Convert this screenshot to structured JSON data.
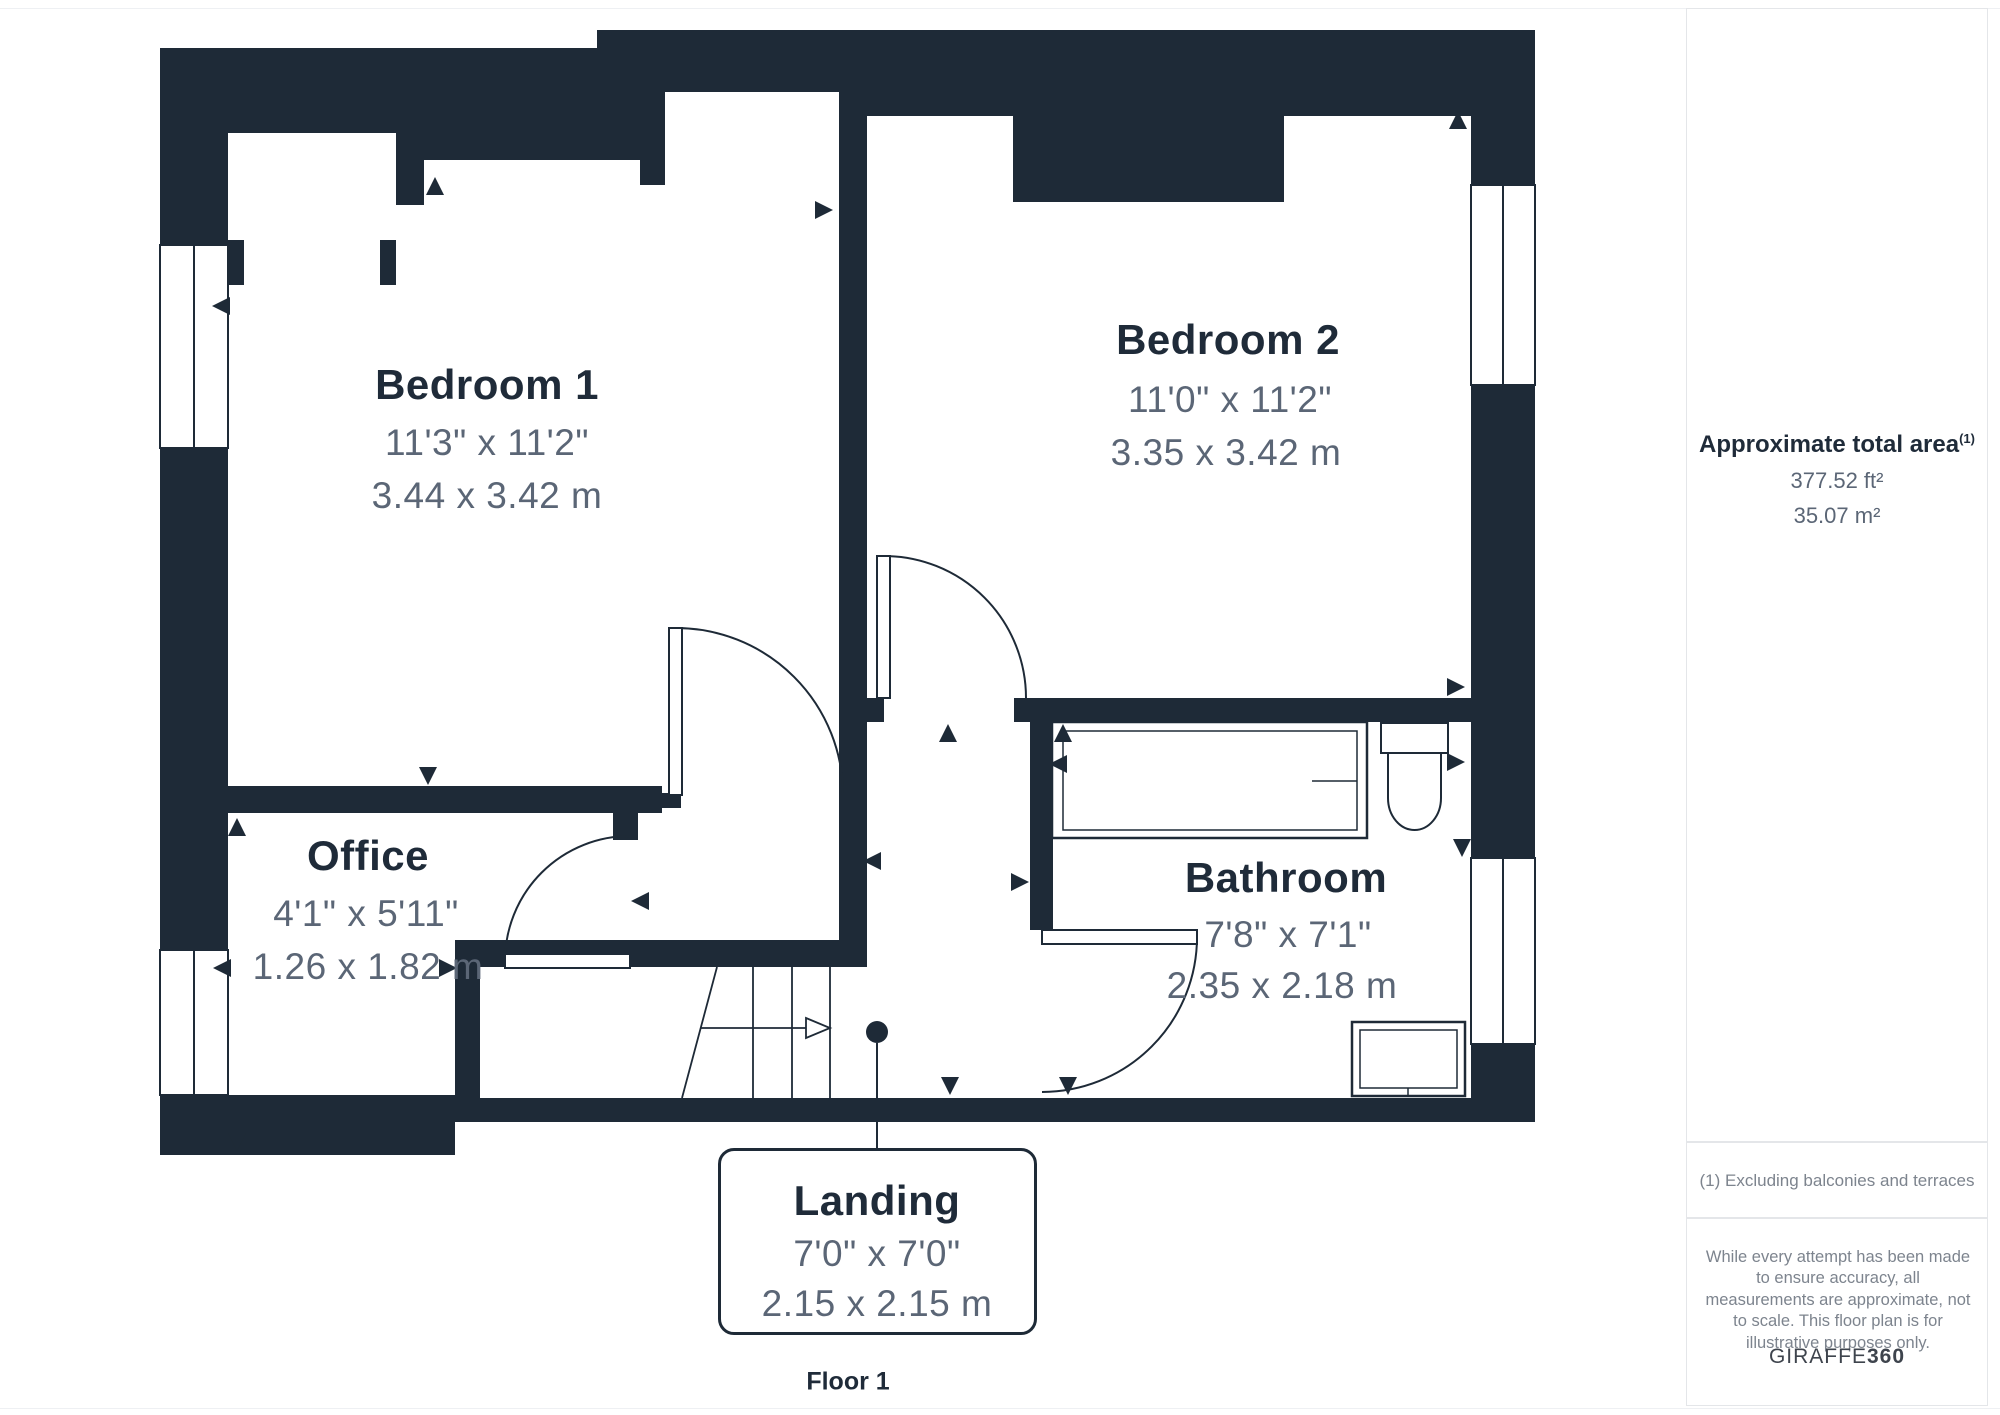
{
  "plan": {
    "floor_label": "Floor 1",
    "rooms": {
      "bedroom1": {
        "name": "Bedroom 1",
        "dims_imperial": "11'3\" x 11'2\"",
        "dims_metric": "3.44 x 3.42 m"
      },
      "bedroom2": {
        "name": "Bedroom 2",
        "dims_imperial": "11'0\" x 11'2\"",
        "dims_metric": "3.35 x 3.42 m"
      },
      "office": {
        "name": "Office",
        "dims_imperial": "4'1\" x 5'11\"",
        "dims_metric": "1.26 x 1.82 m"
      },
      "bathroom": {
        "name": "Bathroom",
        "dims_imperial": "7'8\" x 7'1\"",
        "dims_metric": "2.35 x 2.18 m"
      },
      "landing": {
        "name": "Landing",
        "dims_imperial": "7'0\" x 7'0\"",
        "dims_metric": "2.15 x 2.15 m"
      }
    }
  },
  "sidebar": {
    "area_title": "Approximate total area",
    "area_footnote_marker": "(1)",
    "area_ft": "377.52 ft²",
    "area_m": "35.07 m²",
    "footnote": "(1) Excluding balconies and terraces",
    "disclaimer": "While every attempt has been made to ensure accuracy, all measurements are approximate, not to scale. This floor plan is for illustrative purposes only.",
    "brand_primary": "GIRAFFE",
    "brand_secondary": "360"
  },
  "colors": {
    "wall": "#1e2a37",
    "room_name": "#1f2b39",
    "dims_text": "#5b6676",
    "panel_border": "#e4e6e9",
    "muted_text": "#7d848e"
  }
}
